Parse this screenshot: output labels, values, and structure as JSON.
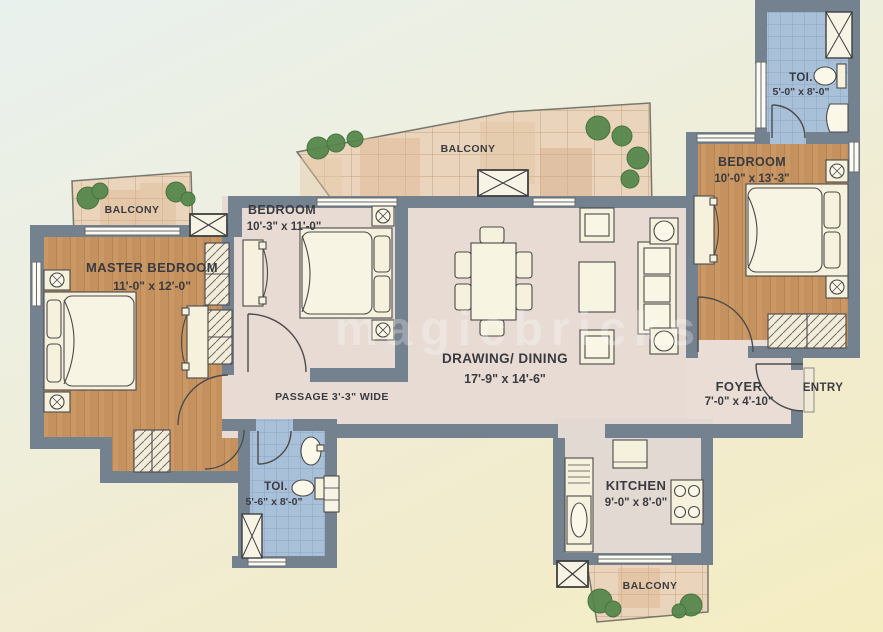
{
  "palette": {
    "wall": "#74818e",
    "wood_floor": "#c5925f",
    "tile_blue": "#a9c0d9",
    "tile_beige": "#ead5bc",
    "floor_pink": "#e7dbd4",
    "furniture": "#f6f1dc",
    "plant_green": "#528549",
    "background_top": "#e9f1ee",
    "background_bottom": "#f4edc2",
    "label_text": "#3a3b40"
  },
  "watermark": "magicbricks",
  "rooms": {
    "master_bedroom": {
      "name": "MASTER BEDROOM",
      "dims": "11'-0\" x 12'-0\""
    },
    "bedroom_top": {
      "name": "BEDROOM",
      "dims": "10'-3\" x 11'-0\""
    },
    "bedroom_right": {
      "name": "BEDROOM",
      "dims": "10'-0\" x 13'-3\""
    },
    "drawing_dining": {
      "name": "DRAWING/ DINING",
      "dims": "17'-9\" x 14'-6\""
    },
    "kitchen": {
      "name": "KITCHEN",
      "dims": "9'-0\" x 8'-0\""
    },
    "foyer": {
      "name": "FOYER",
      "dims": "7'-0\" x 4'-10\""
    },
    "toilet_upper": {
      "name": "TOI.",
      "dims": "5'-0\" x 8'-0\""
    },
    "toilet_lower": {
      "name": "TOI.",
      "dims": "5'-6\" x 8'-0\""
    },
    "passage": {
      "label": "PASSAGE 3'-3\" WIDE"
    },
    "entry": {
      "label": "ENTRY"
    },
    "balcony_left": {
      "name": "BALCONY"
    },
    "balcony_top": {
      "name": "BALCONY"
    },
    "balcony_bottom": {
      "name": "BALCONY"
    }
  }
}
